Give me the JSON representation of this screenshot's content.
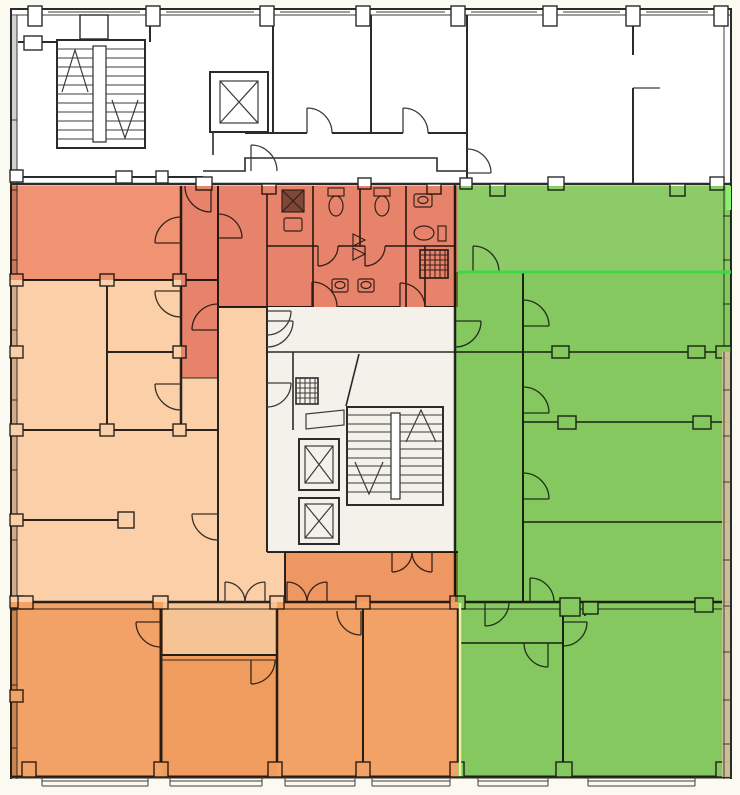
{
  "plan": {
    "canvas": {
      "width": 740,
      "height": 795
    },
    "palette": {
      "page_bg": "#fbfaf1",
      "paper": "#ffffff",
      "wall": "#2b2b2b",
      "line": "#3c3c3c",
      "core_fill": "#f3f1ea",
      "glass_west": "#a6a6a6",
      "window_tan": "#c9ba8f",
      "boundary_yellow": "#f3eda8",
      "highlight_green": "#3cd944",
      "highlight_green_light": "#8aef70"
    },
    "zones": [
      {
        "id": "nw-upper-room",
        "color": "#ef9373"
      },
      {
        "id": "wc-core",
        "color": "#e8836b"
      },
      {
        "id": "wc-corridor-strip",
        "color": "#e8836b"
      },
      {
        "id": "west-wing",
        "color": "#fbd0a8"
      },
      {
        "id": "central-mid-room",
        "color": "#ee9763"
      },
      {
        "id": "south-anteroom",
        "color": "#f6c494"
      },
      {
        "id": "south-inner-room",
        "color": "#f09c5e"
      },
      {
        "id": "south-wing-west",
        "color": "#f2a266"
      },
      {
        "id": "south-wing-mid",
        "color": "#f2a266"
      },
      {
        "id": "east-wing-upper",
        "color": "#8ccb68"
      },
      {
        "id": "east-wing",
        "color": "#85c85f"
      }
    ]
  }
}
